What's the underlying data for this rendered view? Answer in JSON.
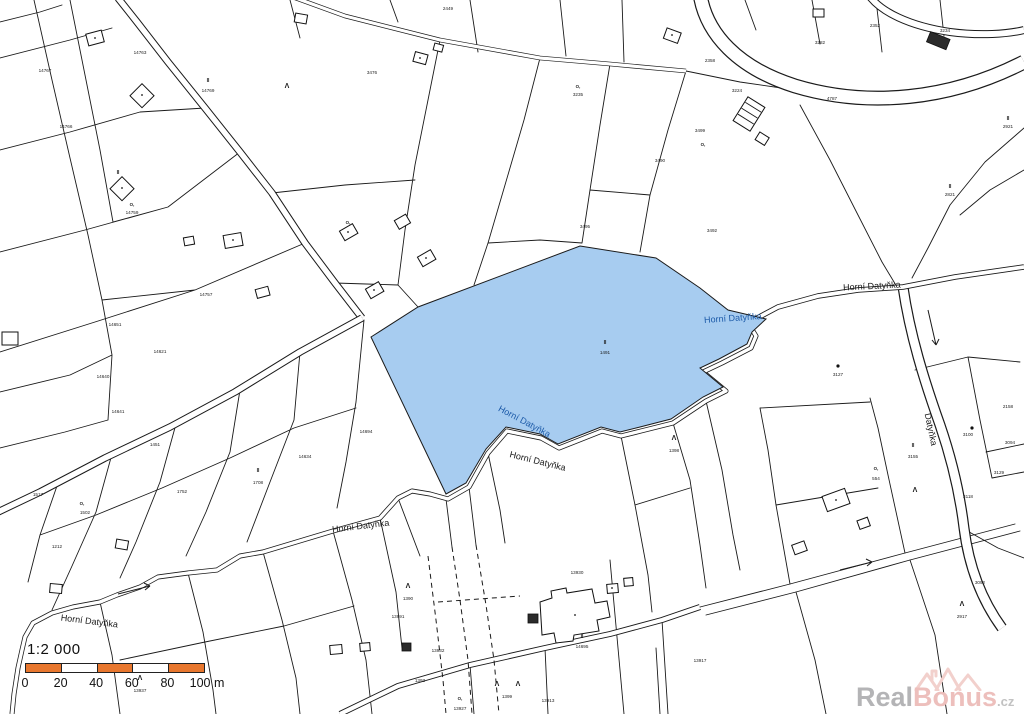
{
  "colors": {
    "highlight_fill": "#a7ccf0",
    "line": "#1a1a1a",
    "stream_label_blue": "#1c5aa8",
    "highlight_label": "#14366b",
    "scale_orange": "#e8772e",
    "watermark_gray": "#b4b4b6",
    "watermark_pink": "#edbfbc"
  },
  "scale": {
    "title": "1:2 000",
    "segment_colors": [
      "#e8772e",
      "#ffffff",
      "#e8772e",
      "#ffffff",
      "#e8772e"
    ],
    "ticks": [
      {
        "t": "0",
        "x": 0
      },
      {
        "t": "20",
        "x": 35.6
      },
      {
        "t": "40",
        "x": 71.2
      },
      {
        "t": "60",
        "x": 106.8
      },
      {
        "t": "80",
        "x": 142.4
      },
      {
        "t": "100 m",
        "x": 182
      }
    ]
  },
  "watermark": {
    "part1": "Real",
    "part2": "Bonus",
    "suffix": ".cz"
  },
  "map": {
    "highlight_parcel": {
      "symbol": "II",
      "number": "1491",
      "x": 605,
      "y": 354
    },
    "stream_labels": [
      {
        "text": "Horní Datyňka",
        "x": 733,
        "y": 321,
        "rot": -4,
        "color": "#1c5aa8"
      },
      {
        "text": "Horní Datyňka",
        "x": 872,
        "y": 289,
        "rot": -3,
        "color": "#1a1a1a"
      },
      {
        "text": "Horní Datyňka",
        "x": 523,
        "y": 424,
        "rot": 28,
        "color": "#1c5aa8"
      },
      {
        "text": "Horní Datyňka",
        "x": 537,
        "y": 464,
        "rot": 14,
        "color": "#1a1a1a"
      },
      {
        "text": "Horní Datyňka",
        "x": 361,
        "y": 529,
        "rot": -7,
        "color": "#1a1a1a"
      },
      {
        "text": "Horní Datyňka",
        "x": 89,
        "y": 624,
        "rot": 7,
        "color": "#1a1a1a"
      },
      {
        "text": "Datyňka",
        "x": 928,
        "y": 430,
        "rot": 78,
        "color": "#1a1a1a"
      }
    ],
    "parcel_numbers": [
      {
        "t": "14767",
        "x": 45,
        "y": 72
      },
      {
        "t": "14763",
        "x": 140,
        "y": 54
      },
      {
        "t": "14769",
        "x": 208,
        "y": 92
      },
      {
        "t": "14759",
        "x": 132,
        "y": 214
      },
      {
        "t": "14757",
        "x": 206,
        "y": 296
      },
      {
        "t": "14766",
        "x": 66,
        "y": 128
      },
      {
        "t": "14651",
        "x": 115,
        "y": 326
      },
      {
        "t": "14621",
        "x": 160,
        "y": 353
      },
      {
        "t": "14640",
        "x": 103,
        "y": 378
      },
      {
        "t": "14641",
        "x": 118,
        "y": 413
      },
      {
        "t": "1451",
        "x": 155,
        "y": 446
      },
      {
        "t": "1517",
        "x": 38,
        "y": 496
      },
      {
        "t": "1502",
        "x": 85,
        "y": 514
      },
      {
        "t": "1212",
        "x": 57,
        "y": 548
      },
      {
        "t": "1752",
        "x": 182,
        "y": 493
      },
      {
        "t": "1708",
        "x": 258,
        "y": 484
      },
      {
        "t": "14634",
        "x": 305,
        "y": 458
      },
      {
        "t": "14694",
        "x": 366,
        "y": 433
      },
      {
        "t": "3476",
        "x": 372,
        "y": 74
      },
      {
        "t": "2449",
        "x": 448,
        "y": 10
      },
      {
        "t": "3235",
        "x": 578,
        "y": 96
      },
      {
        "t": "2358",
        "x": 710,
        "y": 62
      },
      {
        "t": "3282",
        "x": 820,
        "y": 44
      },
      {
        "t": "2352",
        "x": 875,
        "y": 27
      },
      {
        "t": "3234",
        "x": 945,
        "y": 32
      },
      {
        "t": "3224",
        "x": 737,
        "y": 92
      },
      {
        "t": "3499",
        "x": 700,
        "y": 132
      },
      {
        "t": "3490",
        "x": 660,
        "y": 162
      },
      {
        "t": "3495",
        "x": 585,
        "y": 228
      },
      {
        "t": "3492",
        "x": 712,
        "y": 232
      },
      {
        "t": "2821",
        "x": 950,
        "y": 196
      },
      {
        "t": "2921",
        "x": 1008,
        "y": 128
      },
      {
        "t": "3127",
        "x": 838,
        "y": 376
      },
      {
        "t": "3100",
        "x": 968,
        "y": 436
      },
      {
        "t": "3155",
        "x": 913,
        "y": 458
      },
      {
        "t": "2158",
        "x": 1008,
        "y": 408
      },
      {
        "t": "3094",
        "x": 1010,
        "y": 444
      },
      {
        "t": "3129",
        "x": 999,
        "y": 474
      },
      {
        "t": "3118",
        "x": 968,
        "y": 498
      },
      {
        "t": "554",
        "x": 876,
        "y": 480
      },
      {
        "t": "13930",
        "x": 577,
        "y": 574
      },
      {
        "t": "13991",
        "x": 398,
        "y": 618
      },
      {
        "t": "13932",
        "x": 438,
        "y": 652
      },
      {
        "t": "14695",
        "x": 582,
        "y": 648
      },
      {
        "t": "13927",
        "x": 460,
        "y": 710
      },
      {
        "t": "1393",
        "x": 420,
        "y": 682
      },
      {
        "t": "13913",
        "x": 548,
        "y": 702
      },
      {
        "t": "3092",
        "x": 980,
        "y": 584
      },
      {
        "t": "13917",
        "x": 700,
        "y": 662
      },
      {
        "t": "1398",
        "x": 674,
        "y": 452
      },
      {
        "t": "1390",
        "x": 408,
        "y": 600
      },
      {
        "t": "13937",
        "x": 140,
        "y": 692
      },
      {
        "t": "2917",
        "x": 962,
        "y": 618
      },
      {
        "t": "1399",
        "x": 507,
        "y": 698
      },
      {
        "t": "4787",
        "x": 832,
        "y": 100
      }
    ],
    "symbols": [
      {
        "g": "Λ",
        "x": 287,
        "y": 88,
        "s": 7
      },
      {
        "g": "Λ",
        "x": 674,
        "y": 440,
        "s": 7
      },
      {
        "g": "Λ",
        "x": 497,
        "y": 686,
        "s": 7
      },
      {
        "g": "Λ",
        "x": 518,
        "y": 686,
        "s": 7
      },
      {
        "g": "Λ",
        "x": 962,
        "y": 606,
        "s": 7
      },
      {
        "g": "Λ",
        "x": 140,
        "y": 680,
        "s": 7
      },
      {
        "g": "Λ",
        "x": 408,
        "y": 588,
        "s": 7
      },
      {
        "g": "Λ",
        "x": 915,
        "y": 492,
        "s": 7
      },
      {
        "g": "II",
        "x": 208,
        "y": 82,
        "s": 5
      },
      {
        "g": "II",
        "x": 950,
        "y": 188,
        "s": 5
      },
      {
        "g": "II",
        "x": 582,
        "y": 638,
        "s": 5
      },
      {
        "g": "II",
        "x": 258,
        "y": 472,
        "s": 5
      },
      {
        "g": "II",
        "x": 913,
        "y": 447,
        "s": 5
      },
      {
        "g": "II",
        "x": 118,
        "y": 174,
        "s": 5
      },
      {
        "g": "II",
        "x": 1008,
        "y": 120,
        "s": 5
      },
      {
        "g": "O,",
        "x": 132,
        "y": 206,
        "s": 4.4
      },
      {
        "g": "O,",
        "x": 578,
        "y": 88,
        "s": 4.4
      },
      {
        "g": "O,",
        "x": 703,
        "y": 146,
        "s": 4.4
      },
      {
        "g": "O,",
        "x": 876,
        "y": 470,
        "s": 4.4
      },
      {
        "g": "O,",
        "x": 460,
        "y": 700,
        "s": 4.4
      },
      {
        "g": "O,",
        "x": 82,
        "y": 505,
        "s": 4.4
      },
      {
        "g": "O,",
        "x": 348,
        "y": 224,
        "s": 4.4
      },
      {
        "g": "dot",
        "x": 972,
        "y": 428
      },
      {
        "g": "dot",
        "x": 838,
        "y": 366
      }
    ]
  }
}
